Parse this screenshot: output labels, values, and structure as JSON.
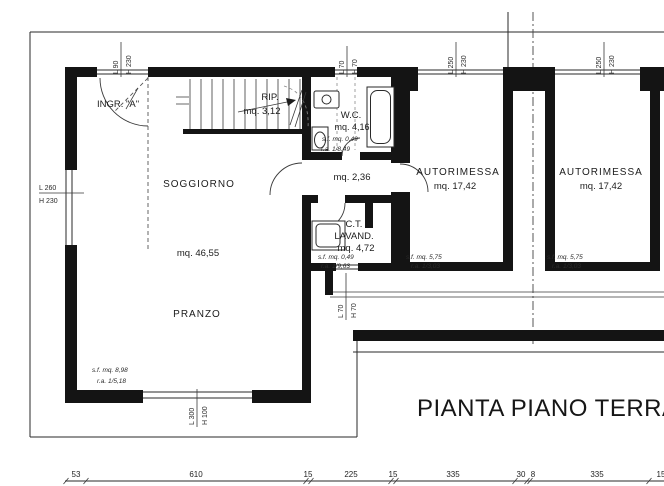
{
  "title": "PIANTA PIANO TERRA",
  "rooms": {
    "ingresso": {
      "label": "INGR. \"A\""
    },
    "rip": {
      "label": "RIP.",
      "area": "mq. 3,12"
    },
    "soggiorno": {
      "label": "SOGGIORNO",
      "area": "mq. 46,55"
    },
    "pranzo": {
      "label": "PRANZO",
      "sf": "s.f. mq. 8,98",
      "ra": "r.a. 1/5,18"
    },
    "wc": {
      "label": "W.C.",
      "area": "mq. 4,16",
      "sf": "s.f. mq. 0,49",
      "ra": "r.a. 1/8,49"
    },
    "disimpegno": {
      "area": "mq. 2,36"
    },
    "lavanderia": {
      "label1": "C.T.",
      "label2": "LAVAND.",
      "area": "mq. 4,72",
      "sf": "s.f. mq. 0,49",
      "ra": "r.a. 1/9,63"
    },
    "autorimessa1": {
      "label": "AUTORIMESSA",
      "area": "mq. 17,42",
      "sf": "s.f. mq. 5,75",
      "ra": "r.a. 1/3,03"
    },
    "autorimessa2": {
      "label": "AUTORIMESSA",
      "area": "mq. 17,42",
      "sf": "s.f. mq. 5,75",
      "ra": "r.a. 1/3,03"
    }
  },
  "openings": {
    "top_window_1": {
      "l": "L 90",
      "h": "H 230"
    },
    "top_window_2": {
      "l": "L 70",
      "h": "H 70"
    },
    "garage_door_1": {
      "l": "L 250",
      "h": "H 230"
    },
    "garage_door_2": {
      "l": "L 250",
      "h": "H 230"
    },
    "left_window": {
      "l": "L 260",
      "h": "H 230"
    },
    "bottom_window": {
      "l": "L 300",
      "h": "H 100"
    },
    "lavanderia_window": {
      "l": "L 70",
      "h": "H 70"
    }
  },
  "dimensions": {
    "values": [
      "53",
      "610",
      "15",
      "225",
      "15",
      "335",
      "30",
      "8",
      "335",
      "15"
    ]
  }
}
